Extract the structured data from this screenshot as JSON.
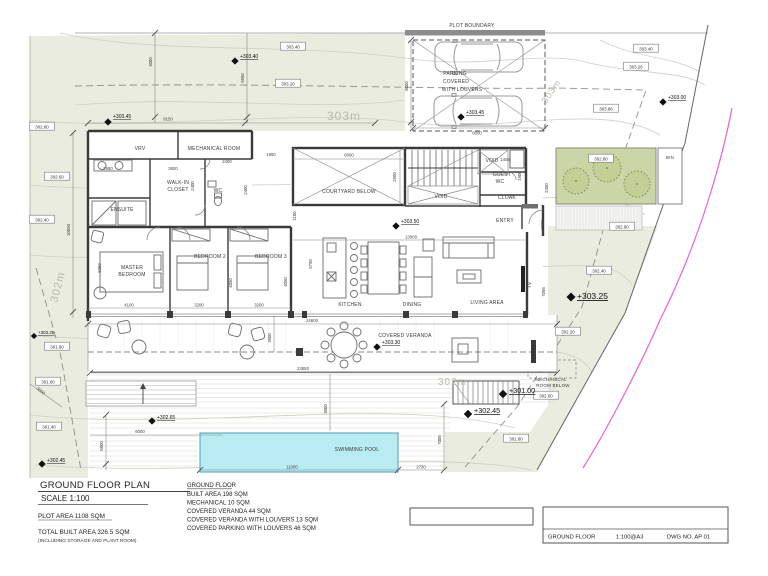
{
  "drawing": {
    "plan_title": "GROUND FLOOR PLAN",
    "scale_line": "SCALE 1:100",
    "plot_area": "PLOT AREA 1108 SQM",
    "total_built": "TOTAL BUILT AREA 326.5 SQM",
    "total_built_note": "(INCLUDING STORAGE AND PLANT ROOM)"
  },
  "notes": {
    "heading": "GROUND FLOOR",
    "items": [
      "BUILT AREA 198 SQM",
      "MECHANICAL 10 SQM",
      "COVERED VERANDA 44 SQM",
      "COVERED VERANDA WITH LOUVERS 13 SQM",
      "COVERED PARKING WITH LOUVERS 46 SQM"
    ]
  },
  "title_block": {
    "drawing_name": "GROUND FLOOR",
    "scale": "1:100@A3",
    "dwg_no": "DWG NO. AP 01"
  },
  "labels": {
    "plot_boundary": "PLOT BOUNDARY",
    "vrv": "VRV",
    "mech_room": "MECHANICAL ROOM",
    "walk_in_1": "WALK-IN",
    "walk_in_2": "CLOSET",
    "wc": "WC",
    "ensuite": "ENSUITE",
    "master_1": "MASTER",
    "master_2": "BEDROOM",
    "bedroom2": "BEDROOM 2",
    "bedroom3": "BEDROOM 3",
    "courtyard": "COURTYARD BELOW",
    "void_a": "VOID",
    "void_b": "VOID",
    "guest_wc_1": "GUEST",
    "guest_wc_2": "WC",
    "cloak": "CLOAK",
    "entry": "ENTRY",
    "kitchen": "KITCHEN",
    "dining": "DINING",
    "living": "LIVING AREA",
    "tv": "TV",
    "covered_veranda": "COVERED VERANDA",
    "swimming_pool": "SWIMMING POOL",
    "mech_below_1": "MECHANICAL",
    "mech_below_2": "ROOM BELOW",
    "parking_1": "PARKING",
    "parking_2": "COVERED",
    "parking_3": "WITH LOUVERS",
    "bin": "BIN"
  },
  "levels": [
    "+303.45",
    "+303.40",
    "+303.45",
    "+303.00",
    "+303.50",
    "+303.30",
    "+303.25",
    "+301.00",
    "+302.45",
    "+302.65",
    "+302.45",
    "+303.25"
  ],
  "spots": [
    "303.40",
    "303.20",
    "303.40",
    "303.26",
    "303.86",
    "302.80",
    "302.60",
    "302.40",
    "302.80",
    "302.80",
    "302.40",
    "302.20",
    "302.00",
    "301.80",
    "301.60",
    "301.40",
    "301.80"
  ],
  "dims": [
    "9150",
    "3000",
    "9550",
    "8000",
    "8000",
    "2950",
    "3600",
    "2400",
    "1950",
    "2400",
    "2400",
    "1405",
    "1900",
    "2400",
    "1500",
    "6000",
    "2900",
    "1100",
    "13000",
    "5790",
    "4100",
    "5350",
    "3200",
    "3200",
    "4050",
    "4050",
    "7056",
    "24600",
    "23850",
    "3500",
    "3000",
    "11000",
    "2730",
    "7006",
    "6000",
    "5800",
    "3000",
    "10050"
  ],
  "contours": [
    "303m",
    "303m",
    "302m",
    "302m"
  ],
  "colors": {
    "terrain": "#e9ecdf",
    "planting": "#cbd5a5",
    "pool": "#b9ebf2",
    "boundary_magenta": "#ea5fd8",
    "wall": "#3a3a3a"
  }
}
